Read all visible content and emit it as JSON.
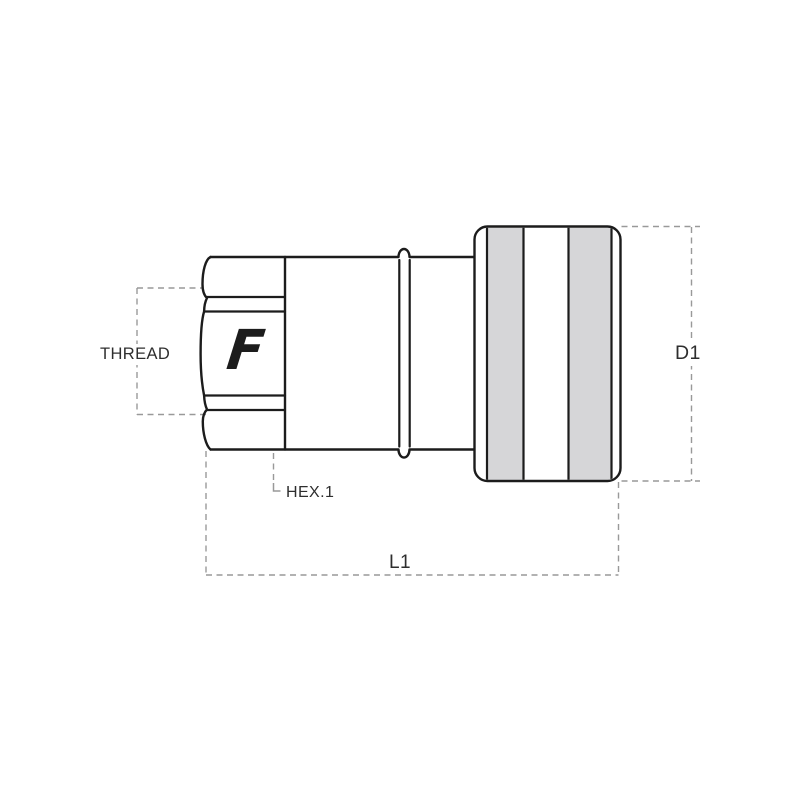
{
  "drawing": {
    "brand_logo": "F",
    "labels": {
      "thread": "THREAD",
      "hex1": "HEX.1",
      "l1": "L1",
      "d1": "D1"
    },
    "colors": {
      "outline": "#1c1c1c",
      "dimension": "#999999",
      "band_fill": "#d6d6d8",
      "text": "#2e2e2e",
      "background": "#ffffff"
    }
  }
}
